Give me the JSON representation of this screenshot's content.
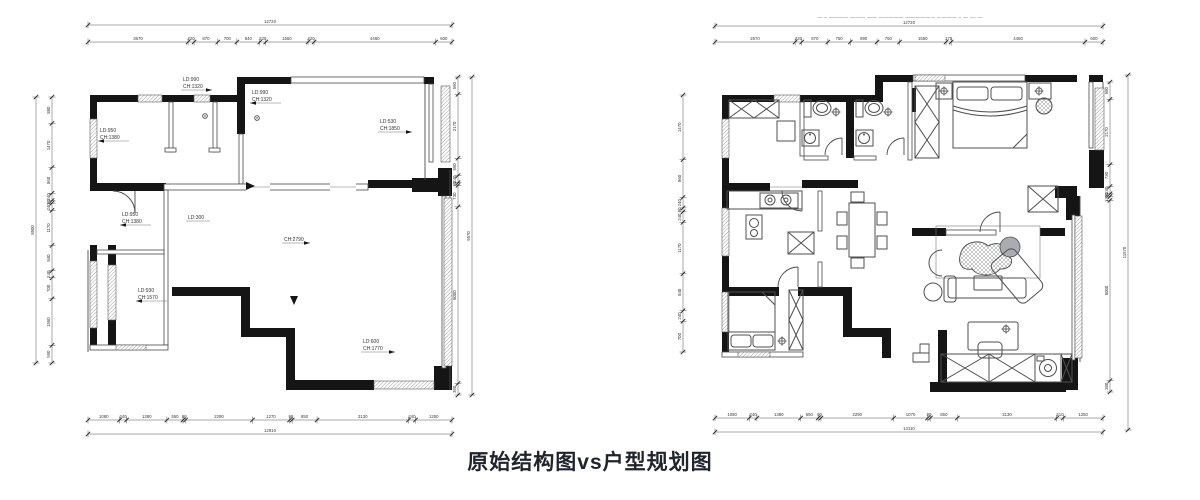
{
  "title": "原始结构图vs户型规划图",
  "colors": {
    "wall": "#151515",
    "line": "#4a4a4a",
    "dim": "#3a3a3a",
    "title": "#20242c"
  },
  "left_plan": {
    "annotations": [
      {
        "l1": "LD:990",
        "l2": "CH:1320"
      },
      {
        "l1": "LD:990",
        "l2": "CH:1320"
      },
      {
        "l1": "LD:950",
        "l2": "CH:1380"
      },
      {
        "l1": "LD:950",
        "l2": "CH:1380"
      },
      {
        "l1": "LD:930",
        "l2": "CH:1570"
      },
      {
        "l1": "LD:530",
        "l2": "CH:1850"
      },
      {
        "l1": "LD:600",
        "l2": "CH:1770"
      },
      {
        "l1": "CH:2790",
        "l2": ""
      },
      {
        "l1": "LD:300",
        "l2": ""
      }
    ],
    "dims": {
      "top_total": [
        "12720"
      ],
      "top": [
        "3670",
        "220",
        "870",
        "700",
        "840",
        "220",
        "1550",
        "220",
        "4460",
        "600"
      ],
      "left_total": [
        "8500"
      ],
      "left": [
        "880",
        "1470",
        "860",
        "240",
        "90",
        "240",
        "1170",
        "840",
        "240",
        "700",
        "1550",
        "590"
      ],
      "right_total": [
        "9570"
      ],
      "right": [
        "590",
        "2170",
        "590",
        "240",
        "90",
        "730",
        "6000",
        "390"
      ],
      "bottom_total": [
        "12910"
      ],
      "bottom": [
        "1080",
        "240",
        "1380",
        "550",
        "90",
        "2290",
        "1270",
        "90",
        "850",
        "3130",
        "240",
        "1250"
      ]
    }
  },
  "right_plan": {
    "watermark": "— – ———— ——— —— ————— —————— ———— – — –– —",
    "dims": {
      "top_total": [
        "12720"
      ],
      "top": [
        "2670",
        "220",
        "870",
        "750",
        "890",
        "750",
        "1550",
        "170",
        "4460",
        "600"
      ],
      "left": [
        "1470",
        "860",
        "240",
        "90",
        "240",
        "1170",
        "840",
        "240",
        "700"
      ],
      "right": [
        "580",
        "2170",
        "730",
        "240",
        "90",
        "130",
        "6000",
        "380"
      ],
      "right_total": [
        "11570"
      ],
      "bottom": [
        "1080",
        "240",
        "1380",
        "550",
        "90",
        "2290",
        "1070",
        "90",
        "850",
        "3130",
        "210",
        "1250"
      ],
      "bottom_total": [
        "13110"
      ]
    }
  }
}
